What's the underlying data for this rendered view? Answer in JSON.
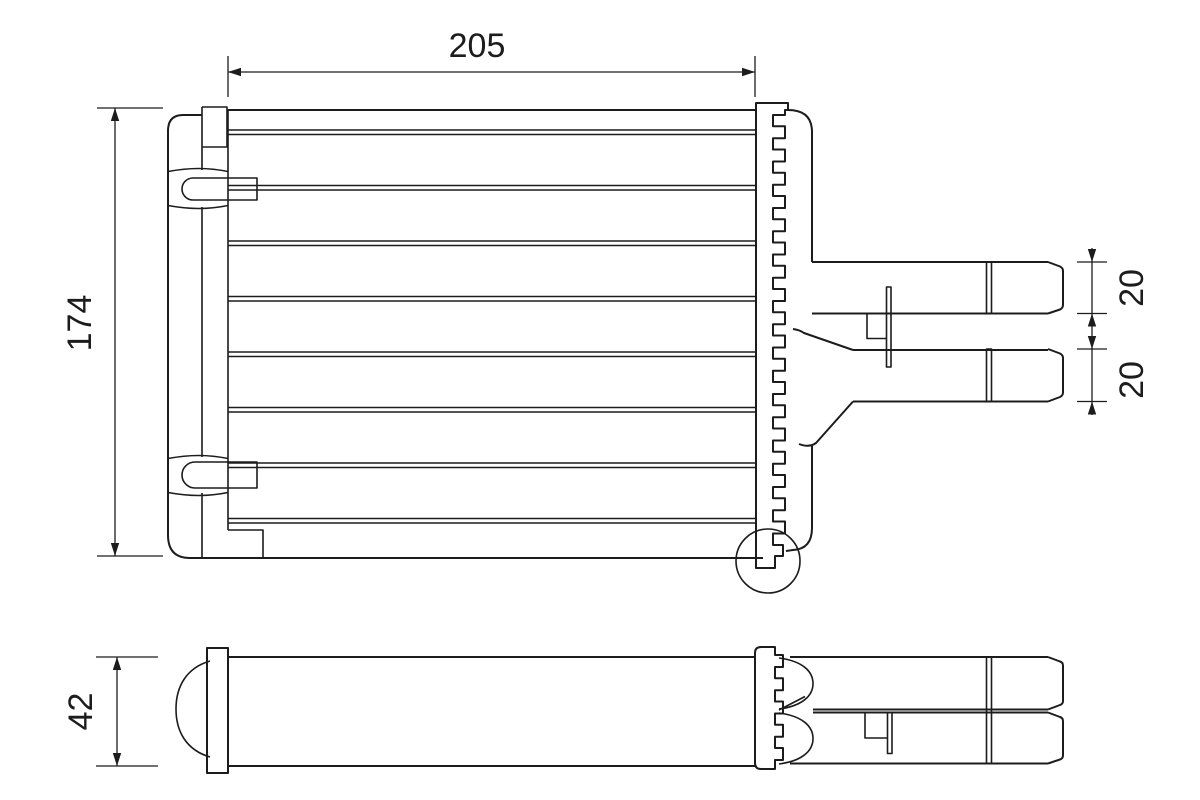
{
  "background_color": "#ffffff",
  "line_color": "#1c1c1c",
  "dimensions": {
    "width": "205",
    "height": "174",
    "upper_pipe": "20",
    "lower_pipe": "20",
    "depth": "42"
  }
}
